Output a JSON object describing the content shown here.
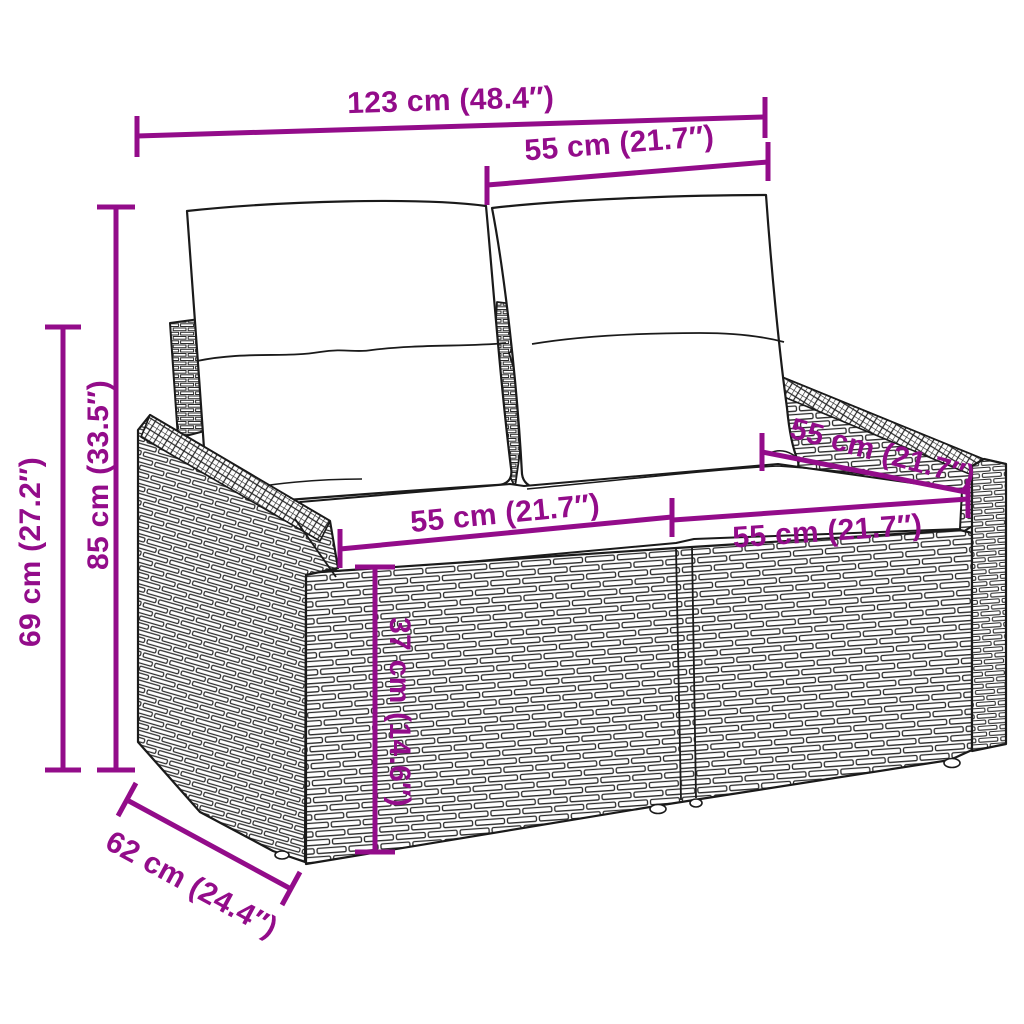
{
  "diagram": {
    "kind": "product-dimension-diagram",
    "subject": "poly-rattan-garden-sofa-with-cushions",
    "accent_color": "#930C8A",
    "line_color": "#1A1A1A",
    "background_color": "#FFFFFF"
  },
  "dims": {
    "overall_width": {
      "label": "123 cm (48.4″)"
    },
    "back_width": {
      "label": "55 cm (21.7″)"
    },
    "overall_height": {
      "label": "85 cm (33.5″)"
    },
    "armrest_height": {
      "label": "69 cm (27.2″)"
    },
    "seat_width_left": {
      "label": "55 cm (21.7″)"
    },
    "seat_width_right": {
      "label": "55 cm (21.7″)"
    },
    "seat_depth": {
      "label": "55 cm (21.7″)"
    },
    "seat_height": {
      "label": "37 cm (14.6″)"
    },
    "overall_depth": {
      "label": "62 cm (24.4″)"
    }
  }
}
